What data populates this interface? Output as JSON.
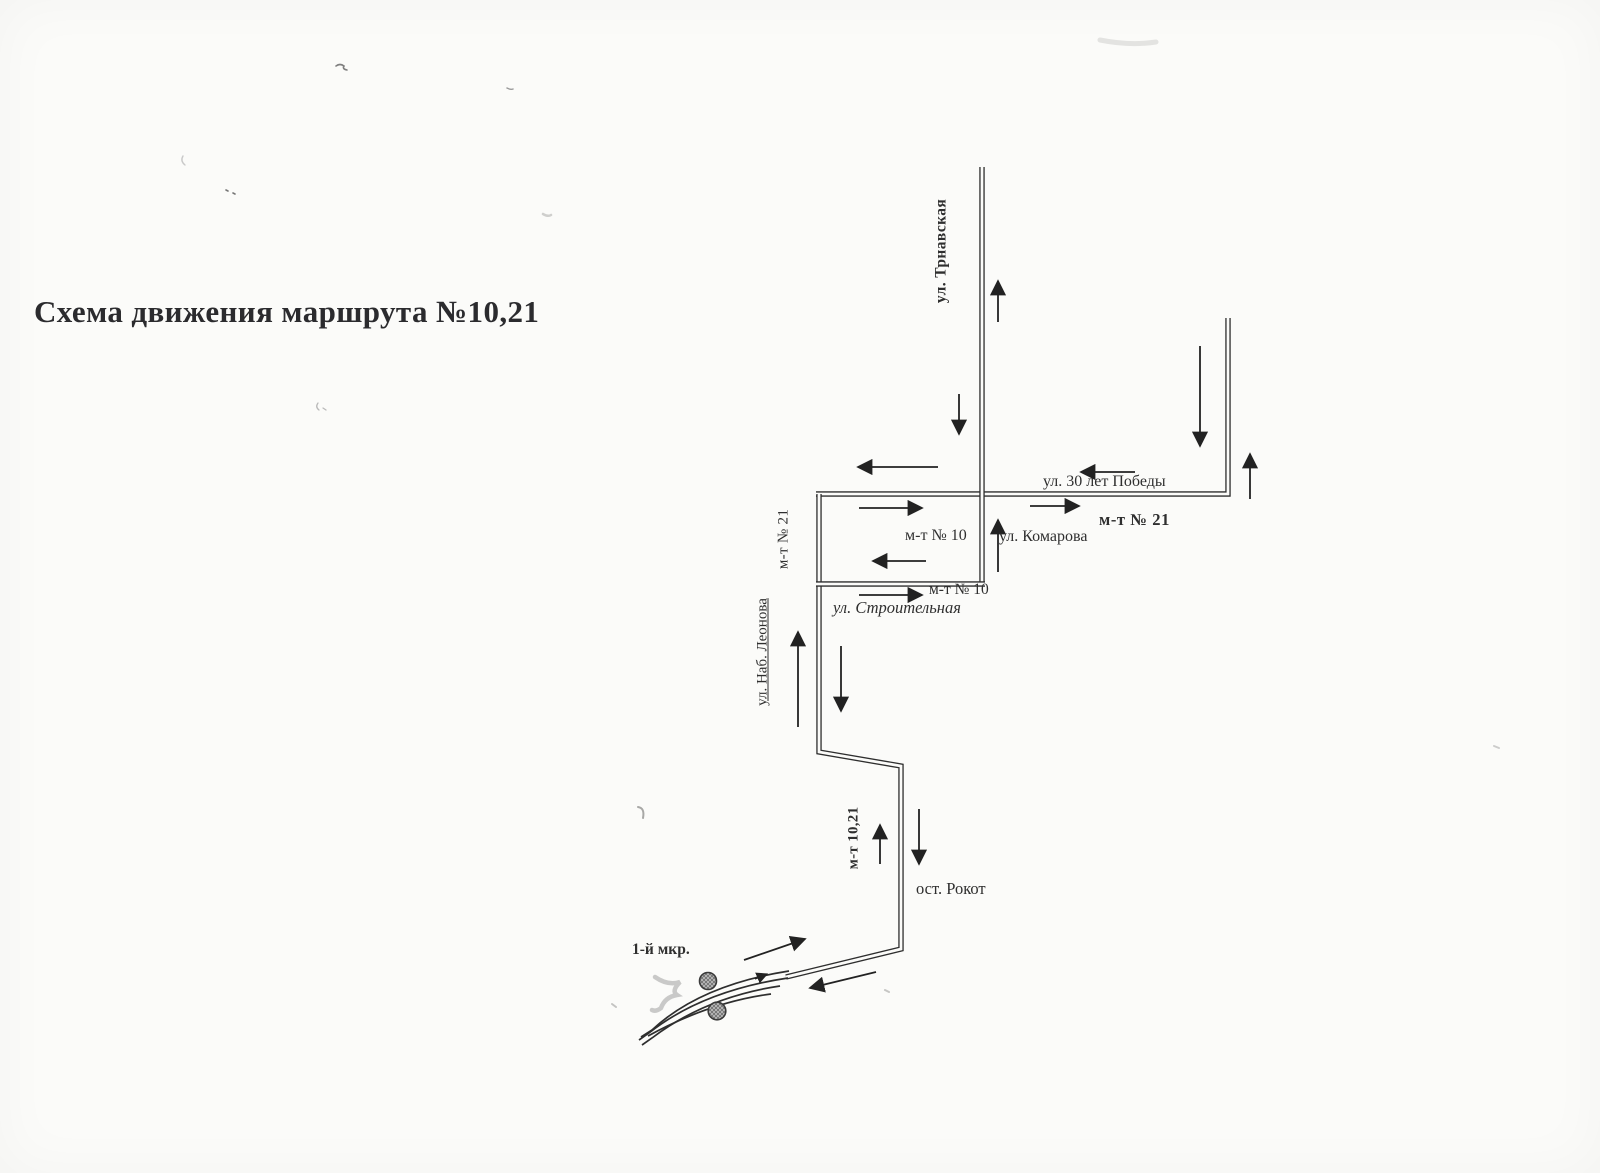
{
  "page": {
    "title": "Схема движения маршрута №10,21"
  },
  "map": {
    "streets": {
      "trnavskaya": "ул. Трнавская",
      "pobedy": "ул. 30 лет Победы",
      "komarova": "ул. Комарова",
      "stroitelnaya": "ул. Строительная",
      "nab_leonova": "ул. Наб. Леонова"
    },
    "routes": {
      "mt21_bold": "м-т № 21",
      "mt10_loop": "м-т № 10",
      "mt21_vertical": "м-т № 21",
      "mt10_stroitelnaya": "м-т № 10",
      "mt1021": "м-т 10,21"
    },
    "stops": {
      "rokot": "ост. Рокот",
      "mkr1": "1-й мкр."
    }
  },
  "colors": {
    "ink": "#2e2e2e",
    "paper": "#fbfbf9",
    "stop_fill": "#c2c2c2",
    "stop_hatch": "#6e6e6e"
  }
}
